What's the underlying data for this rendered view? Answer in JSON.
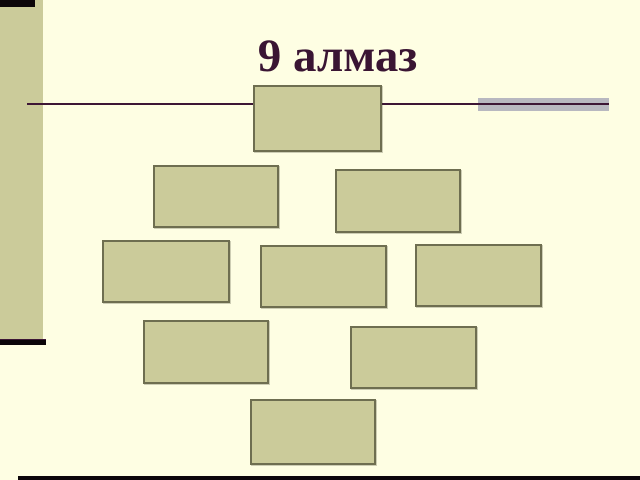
{
  "slide": {
    "title": "9 алмаз"
  },
  "colors": {
    "background": "#FEFEE3",
    "olive": "#CBCB9A",
    "box_fill": "#CBCB9A",
    "box_border": "#6E6E50",
    "maroon": "#3D1635",
    "title_color": "#3A1533",
    "accent_gray": "#B8B8C0",
    "accent_black": "#0B0509"
  },
  "diagram": {
    "type": "nine-diamond-layout",
    "box_count": 9,
    "boxes": [
      {
        "x": 253,
        "y": 85,
        "w": 129,
        "h": 67,
        "label": ""
      },
      {
        "x": 153,
        "y": 165,
        "w": 126,
        "h": 63,
        "label": ""
      },
      {
        "x": 335,
        "y": 169,
        "w": 126,
        "h": 64,
        "label": ""
      },
      {
        "x": 102,
        "y": 240,
        "w": 128,
        "h": 63,
        "label": ""
      },
      {
        "x": 260,
        "y": 245,
        "w": 127,
        "h": 63,
        "label": ""
      },
      {
        "x": 415,
        "y": 244,
        "w": 127,
        "h": 63,
        "label": ""
      },
      {
        "x": 143,
        "y": 320,
        "w": 126,
        "h": 64,
        "label": ""
      },
      {
        "x": 350,
        "y": 326,
        "w": 127,
        "h": 63,
        "label": ""
      },
      {
        "x": 250,
        "y": 399,
        "w": 126,
        "h": 66,
        "label": ""
      }
    ]
  }
}
